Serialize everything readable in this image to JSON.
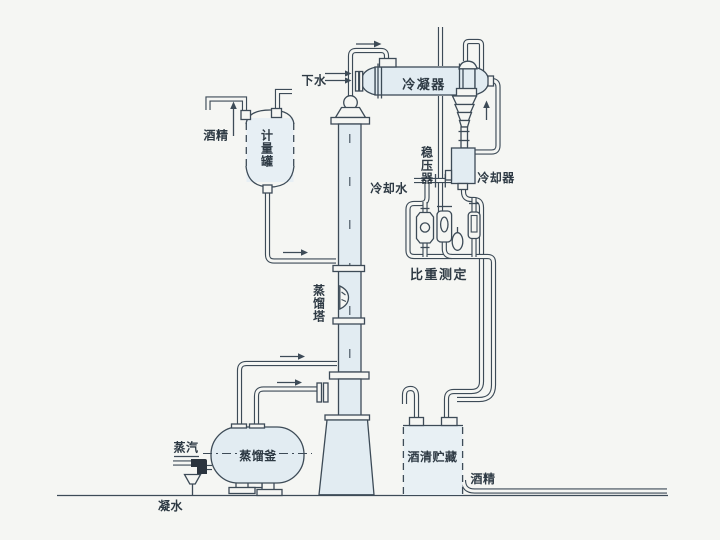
{
  "title": "酒精蒸馏流程图 (alcohol distillation process flow diagram)",
  "colors": {
    "paper": "#f5f6f3",
    "line": "#3d4b57",
    "vessel_fill": "#e2ecf2",
    "text": "#2e3a44"
  },
  "labels": {
    "drain_water": "下水",
    "condenser": "冷凝器",
    "alcohol_feed": "酒精",
    "metering_tank": "计量罐",
    "stabilizer": "稳压器",
    "cooling_water": "冷却水",
    "cooler": "冷却器",
    "gravity_measure": "比重测定",
    "column": "蒸馏塔",
    "kettle": "蒸馏釜",
    "steam": "蒸汽",
    "condensate": "凝水",
    "storage_tank": "酒清贮藏",
    "alcohol_out": "酒精"
  },
  "flow_arrows": [
    {
      "at": "column-top-to-condenser",
      "direction": "right"
    },
    {
      "at": "drain-water-inlet",
      "direction": "right",
      "count": 2
    },
    {
      "at": "condenser-outlet-riser",
      "direction": "up"
    },
    {
      "at": "alcohol-feed-to-metering-tank",
      "direction": "up"
    },
    {
      "at": "metering-tank-to-column",
      "direction": "right"
    },
    {
      "at": "kettle-vapor-to-column",
      "direction": "right"
    },
    {
      "at": "kettle-return-line",
      "direction": "right"
    }
  ]
}
